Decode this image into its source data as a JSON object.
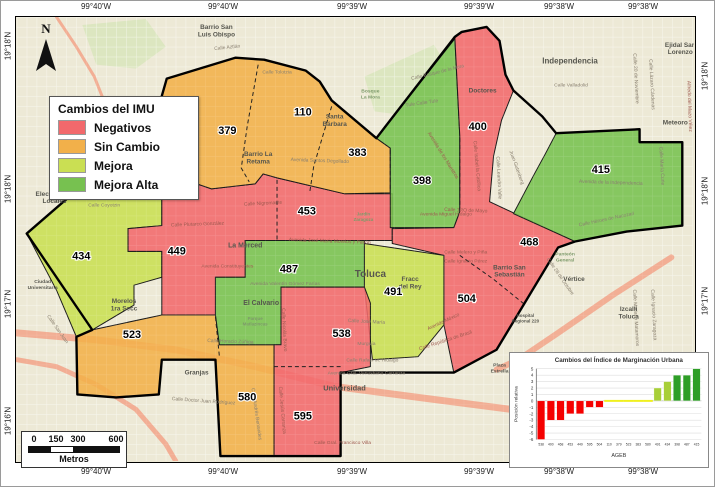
{
  "colors": {
    "negativos": "#F2696C",
    "sin_cambio": "#F2B04A",
    "mejora": "#CADF53",
    "mejora_alta": "#77C150",
    "chart": {
      "neg": "#F50000",
      "zero": "#F0F01E",
      "imp": "#A8CF38",
      "imp_high": "#2E9E27"
    }
  },
  "legend": {
    "title": "Cambios del IMU",
    "items": [
      {
        "label": "Negativos",
        "color": "#F2696C"
      },
      {
        "label": "Sin Cambio",
        "color": "#F2B04A"
      },
      {
        "label": "Mejora",
        "color": "#CADF53"
      },
      {
        "label": "Mejora Alta",
        "color": "#77C150"
      }
    ]
  },
  "north": {
    "label": "N"
  },
  "scale_bar": {
    "ticks": [
      "0",
      "150",
      "300",
      "600"
    ],
    "unit": "Metros"
  },
  "frame": {
    "top_labels": [
      {
        "text": "99°40'W",
        "x": 95
      },
      {
        "text": "99°40'W",
        "x": 222
      },
      {
        "text": "99°39'W",
        "x": 351
      },
      {
        "text": "99°39'W",
        "x": 478
      },
      {
        "text": "99°38'W",
        "x": 558
      },
      {
        "text": "99°38'W",
        "x": 642
      }
    ],
    "bottom_labels": [
      {
        "text": "99°40'W",
        "x": 95
      },
      {
        "text": "99°40'W",
        "x": 222
      },
      {
        "text": "99°39'W",
        "x": 351
      },
      {
        "text": "99°39'W",
        "x": 478
      },
      {
        "text": "99°38'W",
        "x": 558
      },
      {
        "text": "99°38'W",
        "x": 642
      }
    ],
    "left_labels": [
      {
        "text": "19°18'N",
        "y": 45
      },
      {
        "text": "19°18'N",
        "y": 188
      },
      {
        "text": "19°17'N",
        "y": 303
      },
      {
        "text": "19°16'N",
        "y": 420
      }
    ],
    "right_labels": [
      {
        "text": "19°18'N",
        "y": 75
      },
      {
        "text": "19°18'N",
        "y": 190
      },
      {
        "text": "19°17'N",
        "y": 300
      },
      {
        "text": "19°16'N",
        "y": 430
      }
    ]
  },
  "map": {
    "outline": "10,218 85,153 134,149 137,111 151,62 220,41 249,43 291,54 305,65 317,84 362,122 441,20 448,15 473,10 486,24 492,58 500,74 529,100 543,117 627,113 627,126 670,126 670,210 614,216 562,226 545,232 483,335 440,358 326,358 326,442 205,442 200,345 146,345 143,380 100,383 61,380 60,322 76,315",
    "regions": [
      {
        "key": "mejora",
        "points": "10,218 85,153 134,149 137,162 146,165 146,210 112,213 112,236 146,236 146,262 118,270 118,290 76,315 60,322 40,275"
      },
      {
        "key": "negativos",
        "points": "134,149 152,158 196,173 240,168 248,158 262,162 330,178 378,178 378,225 230,225 230,262 200,262 200,300 146,300 146,262 146,236 112,236 112,213 146,210 146,165 137,162"
      },
      {
        "key": "sin_cambio",
        "points": "151,62 220,41 249,43 291,54 305,65 317,84 362,122 376,132 376,177 330,178 262,162 248,158 240,168 196,173 152,158 134,149 137,111"
      },
      {
        "key": "mejora_alta",
        "points": "362,122 441,22 446,120 446,196 440,212 376,212 376,132"
      },
      {
        "key": "negativos",
        "points": "441,20 448,15 473,10 486,24 492,58 500,74 488,104 480,140 476,186 562,226 545,232 483,335 440,358 430,310 430,240 378,228 378,213 440,212 446,196 446,120"
      },
      {
        "key": "sin_cambio",
        "points": "60,322 76,315 146,300 200,300 204,330 259,330 259,442 205,442 200,345 146,345 143,380 100,383 61,380"
      },
      {
        "key": "mejora_alta",
        "points": "230,225 350,225 350,272 266,272 266,330 204,330 200,300 200,262 230,262"
      },
      {
        "key": "mejora",
        "points": "350,228 430,240 430,310 404,342 358,345 350,272"
      },
      {
        "key": "mejora_alta",
        "points": "543,117 627,113 627,126 670,126 670,210 614,216 562,226 500,198 520,160 532,138"
      },
      {
        "key": "negativos",
        "points": "266,272 350,272 356,288 356,352 326,358 326,442 259,442 259,330 266,330"
      }
    ],
    "dividers": [
      "243,48 232,110 226,152 234,166",
      "317,90 299,150 295,176",
      "376,134 376,176",
      "446,122 446,194",
      "262,164 262,224",
      "446,240 480,264 512,290",
      "259,352 326,352",
      "200,302 204,342"
    ],
    "roads": [
      {
        "points": "0,318 80,325 160,335 240,352 320,372 420,385 520,398 620,408 681,412",
        "w": 7
      },
      {
        "points": "659,242 600,280 545,318 505,345 483,355",
        "w": 6
      },
      {
        "points": "0,345 40,352 80,370 120,395 150,430 160,447",
        "w": 5
      },
      {
        "points": "40,0 60,30 78,60 90,90",
        "w": 3
      }
    ],
    "parks": [
      "66,8 130,2 150,30 120,52 80,48",
      "350,60 420,28 440,60 400,100 360,95"
    ],
    "districts": [
      {
        "num": "379",
        "x": 212,
        "y": 118
      },
      {
        "num": "110",
        "x": 288,
        "y": 99
      },
      {
        "num": "383",
        "x": 343,
        "y": 140
      },
      {
        "num": "400",
        "x": 464,
        "y": 114
      },
      {
        "num": "398",
        "x": 408,
        "y": 168
      },
      {
        "num": "415",
        "x": 588,
        "y": 157
      },
      {
        "num": "453",
        "x": 292,
        "y": 199
      },
      {
        "num": "449",
        "x": 161,
        "y": 239
      },
      {
        "num": "434",
        "x": 65,
        "y": 244
      },
      {
        "num": "487",
        "x": 274,
        "y": 257
      },
      {
        "num": "491",
        "x": 379,
        "y": 280
      },
      {
        "num": "468",
        "x": 516,
        "y": 230
      },
      {
        "num": "504",
        "x": 453,
        "y": 287
      },
      {
        "num": "523",
        "x": 116,
        "y": 323
      },
      {
        "num": "538",
        "x": 327,
        "y": 322
      },
      {
        "num": "580",
        "x": 232,
        "y": 386
      },
      {
        "num": "595",
        "x": 288,
        "y": 405
      }
    ],
    "places": [
      {
        "name": "Barrio San\nLuis Obispo",
        "x": 201,
        "y": 12
      },
      {
        "name": "Barrio San Miguel\nApinahuizco",
        "x": 74,
        "y": 84
      },
      {
        "name": "Barrio La\nRetama",
        "x": 243,
        "y": 140
      },
      {
        "name": "Santa\nBárbara",
        "x": 320,
        "y": 102
      },
      {
        "name": "Doctores",
        "x": 469,
        "y": 76
      },
      {
        "name": "Independencia",
        "x": 557,
        "y": 47,
        "size": 8
      },
      {
        "name": "Ejidal San\nLorenzo",
        "x": 668,
        "y": 30
      },
      {
        "name": "Meteoro",
        "x": 663,
        "y": 108
      },
      {
        "name": "Electricistas\nLocales",
        "x": 38,
        "y": 180
      },
      {
        "name": "La Merced",
        "x": 230,
        "y": 232,
        "size": 7
      },
      {
        "name": "Toluca",
        "x": 356,
        "y": 262,
        "size": 10
      },
      {
        "name": "Fracc\ndel Rey",
        "x": 396,
        "y": 266
      },
      {
        "name": "Barrio San\nSebastián",
        "x": 496,
        "y": 254
      },
      {
        "name": "Vértice",
        "x": 561,
        "y": 266
      },
      {
        "name": "Izcalli\nToluca",
        "x": 616,
        "y": 296
      },
      {
        "name": "Morelos\n1ra Secc",
        "x": 108,
        "y": 288
      },
      {
        "name": "El Calvario",
        "x": 246,
        "y": 290,
        "size": 7
      },
      {
        "name": "Parque\nMatlazincas",
        "x": 240,
        "y": 305,
        "size": 4.5,
        "c": "g"
      },
      {
        "name": "Granjas",
        "x": 181,
        "y": 360
      },
      {
        "name": "Universidad",
        "x": 330,
        "y": 376,
        "size": 7.5
      },
      {
        "name": "Ciudad\nUniversitaria",
        "x": 26,
        "y": 268,
        "size": 5
      },
      {
        "name": "Panteón\nGeneral",
        "x": 552,
        "y": 240,
        "size": 5,
        "c": "g"
      },
      {
        "name": "Plaza\nEstrella",
        "x": 486,
        "y": 352,
        "size": 5
      },
      {
        "name": "Club\nToluca",
        "x": 648,
        "y": 384,
        "size": 5
      },
      {
        "name": "Bosque\nLa Mora",
        "x": 356,
        "y": 76,
        "size": 5,
        "c": "g"
      },
      {
        "name": "Jardín\nZaragoza",
        "x": 349,
        "y": 200,
        "size": 4.5,
        "c": "g"
      },
      {
        "name": "Hospital\nRegional 220",
        "x": 512,
        "y": 302,
        "size": 4.5
      }
    ],
    "streets": [
      {
        "name": "Calle Aztlán",
        "x": 212,
        "y": 32,
        "r": -6
      },
      {
        "name": "Calle Tolotzia",
        "x": 262,
        "y": 57,
        "r": 0
      },
      {
        "name": "Avenida Santos Degollado",
        "x": 305,
        "y": 146,
        "r": 2
      },
      {
        "name": "Calle Nigromante",
        "x": 248,
        "y": 189,
        "r": -3,
        "c": "r"
      },
      {
        "name": "Calle Plutarco González",
        "x": 182,
        "y": 210,
        "r": -2,
        "c": "r"
      },
      {
        "name": "Avenida Constituyentes",
        "x": 212,
        "y": 252,
        "r": 0,
        "c": "r"
      },
      {
        "name": "Avenida Valentín Gómez Farías",
        "x": 270,
        "y": 270,
        "r": 0
      },
      {
        "name": "Avenida José María Morelos y Pavón",
        "x": 315,
        "y": 227,
        "r": 2,
        "c": "r"
      },
      {
        "name": "Calle Horacio Zúñiga",
        "x": 215,
        "y": 328,
        "r": 2
      },
      {
        "name": "Calle Nicolás Bravo",
        "x": 268,
        "y": 315,
        "r": 87,
        "c": "r"
      },
      {
        "name": "Calle Jesús Carranza",
        "x": 266,
        "y": 396,
        "r": 85,
        "c": "r"
      },
      {
        "name": "Calle Doctor Juan Rodríguez",
        "x": 188,
        "y": 388,
        "r": 4
      },
      {
        "name": "Calle Gral. Francisco Villa",
        "x": 328,
        "y": 430,
        "r": 0,
        "c": "r"
      },
      {
        "name": "Avenida Miguel Hidalgo",
        "x": 108,
        "y": 128,
        "r": -10
      },
      {
        "name": "Avenida Miguel Hidalgo",
        "x": 432,
        "y": 200,
        "r": 0,
        "c": "r"
      },
      {
        "name": "Calle Texcoco",
        "x": 128,
        "y": 158,
        "r": 0
      },
      {
        "name": "Calle Tenancingo",
        "x": 92,
        "y": 168,
        "r": 0
      },
      {
        "name": "Calle Otumba",
        "x": 92,
        "y": 182,
        "r": 0
      },
      {
        "name": "Calle Coyotzin",
        "x": 88,
        "y": 191,
        "r": 0
      },
      {
        "name": "Calle Valladolid",
        "x": 558,
        "y": 70,
        "r": 0
      },
      {
        "name": "Calle Bosque de la Mora",
        "x": 424,
        "y": 57,
        "r": -14
      },
      {
        "name": "Tule  Calle Tule",
        "x": 408,
        "y": 88,
        "r": -8
      },
      {
        "name": "Avenida de los Maestros",
        "x": 428,
        "y": 140,
        "r": 58,
        "c": "r"
      },
      {
        "name": "Calle Isabel la Católica",
        "x": 462,
        "y": 150,
        "r": 85,
        "c": "r"
      },
      {
        "name": "Calle Leandro Valle",
        "x": 484,
        "y": 162,
        "r": 87
      },
      {
        "name": "Juan Gutenberg",
        "x": 502,
        "y": 152,
        "r": 70
      },
      {
        "name": "Avenida de la Independencia",
        "x": 598,
        "y": 168,
        "r": 2
      },
      {
        "name": "Calle 1RO de Mayo",
        "x": 452,
        "y": 196,
        "r": 2,
        "c": "r"
      },
      {
        "name": "Calle 20 de Noviembre",
        "x": 622,
        "y": 62,
        "r": 87
      },
      {
        "name": "Calle Lázaro Cárdenas",
        "x": 638,
        "y": 68,
        "r": 87
      },
      {
        "name": "Calle Héroes de Nacozari",
        "x": 594,
        "y": 205,
        "r": -12
      },
      {
        "name": "Calle Melero y Piña",
        "x": 452,
        "y": 238,
        "r": 0,
        "c": "r"
      },
      {
        "name": "Calle Ignacio Pérez",
        "x": 452,
        "y": 247,
        "r": 0,
        "c": "r"
      },
      {
        "name": "Calle 28 de Octubre",
        "x": 546,
        "y": 262,
        "r": 55
      },
      {
        "name": "Avenida México",
        "x": 430,
        "y": 308,
        "r": -25,
        "c": "r"
      },
      {
        "name": "Calle República de Brasil",
        "x": 432,
        "y": 327,
        "r": -18,
        "c": "r"
      },
      {
        "name": "Calle Rafael M. Hidalgo",
        "x": 358,
        "y": 347,
        "r": 0
      },
      {
        "name": "Avenida Gral. Venustiano Carranza",
        "x": 352,
        "y": 360,
        "r": 0
      },
      {
        "name": "Murguía",
        "x": 352,
        "y": 330,
        "r": 0
      },
      {
        "name": "Calle José María",
        "x": 352,
        "y": 308,
        "r": 3
      },
      {
        "name": "Calle Andrés Benavides",
        "x": 240,
        "y": 400,
        "r": 82
      },
      {
        "name": "Calle San Juan",
        "x": 40,
        "y": 315,
        "r": 55
      },
      {
        "name": "Calle El Oro",
        "x": 64,
        "y": 128,
        "r": 88
      },
      {
        "name": "Calle María Curie",
        "x": 648,
        "y": 150,
        "r": 87
      },
      {
        "name": "Alfredo del Mazo Vélez",
        "x": 676,
        "y": 90,
        "r": 88,
        "c": "r"
      },
      {
        "name": "Calle Ignacio Zaragoza",
        "x": 640,
        "y": 300,
        "r": 87
      },
      {
        "name": "Calle Mariano Matamoros",
        "x": 622,
        "y": 303,
        "r": 87
      }
    ]
  },
  "chart_data": {
    "type": "bar",
    "title": "Cambios del Índice de Marginación Urbana",
    "xlabel": "AGEB",
    "ylabel": "Posición relativa",
    "ylim": [
      -6,
      5
    ],
    "grid": true,
    "categories": [
      "538",
      "400",
      "468",
      "453",
      "449",
      "595",
      "504",
      "110",
      "379",
      "523",
      "383",
      "580",
      "491",
      "434",
      "398",
      "487",
      "415"
    ],
    "values": [
      -6,
      -3,
      -3,
      -2,
      -2,
      -1,
      -1,
      0,
      0,
      0,
      0,
      0,
      2,
      3,
      4,
      4,
      5
    ],
    "classes": [
      "neg",
      "neg",
      "neg",
      "neg",
      "neg",
      "neg",
      "neg",
      "zero",
      "zero",
      "zero",
      "zero",
      "zero",
      "imp",
      "imp",
      "imp_high",
      "imp_high",
      "imp_high"
    ]
  }
}
